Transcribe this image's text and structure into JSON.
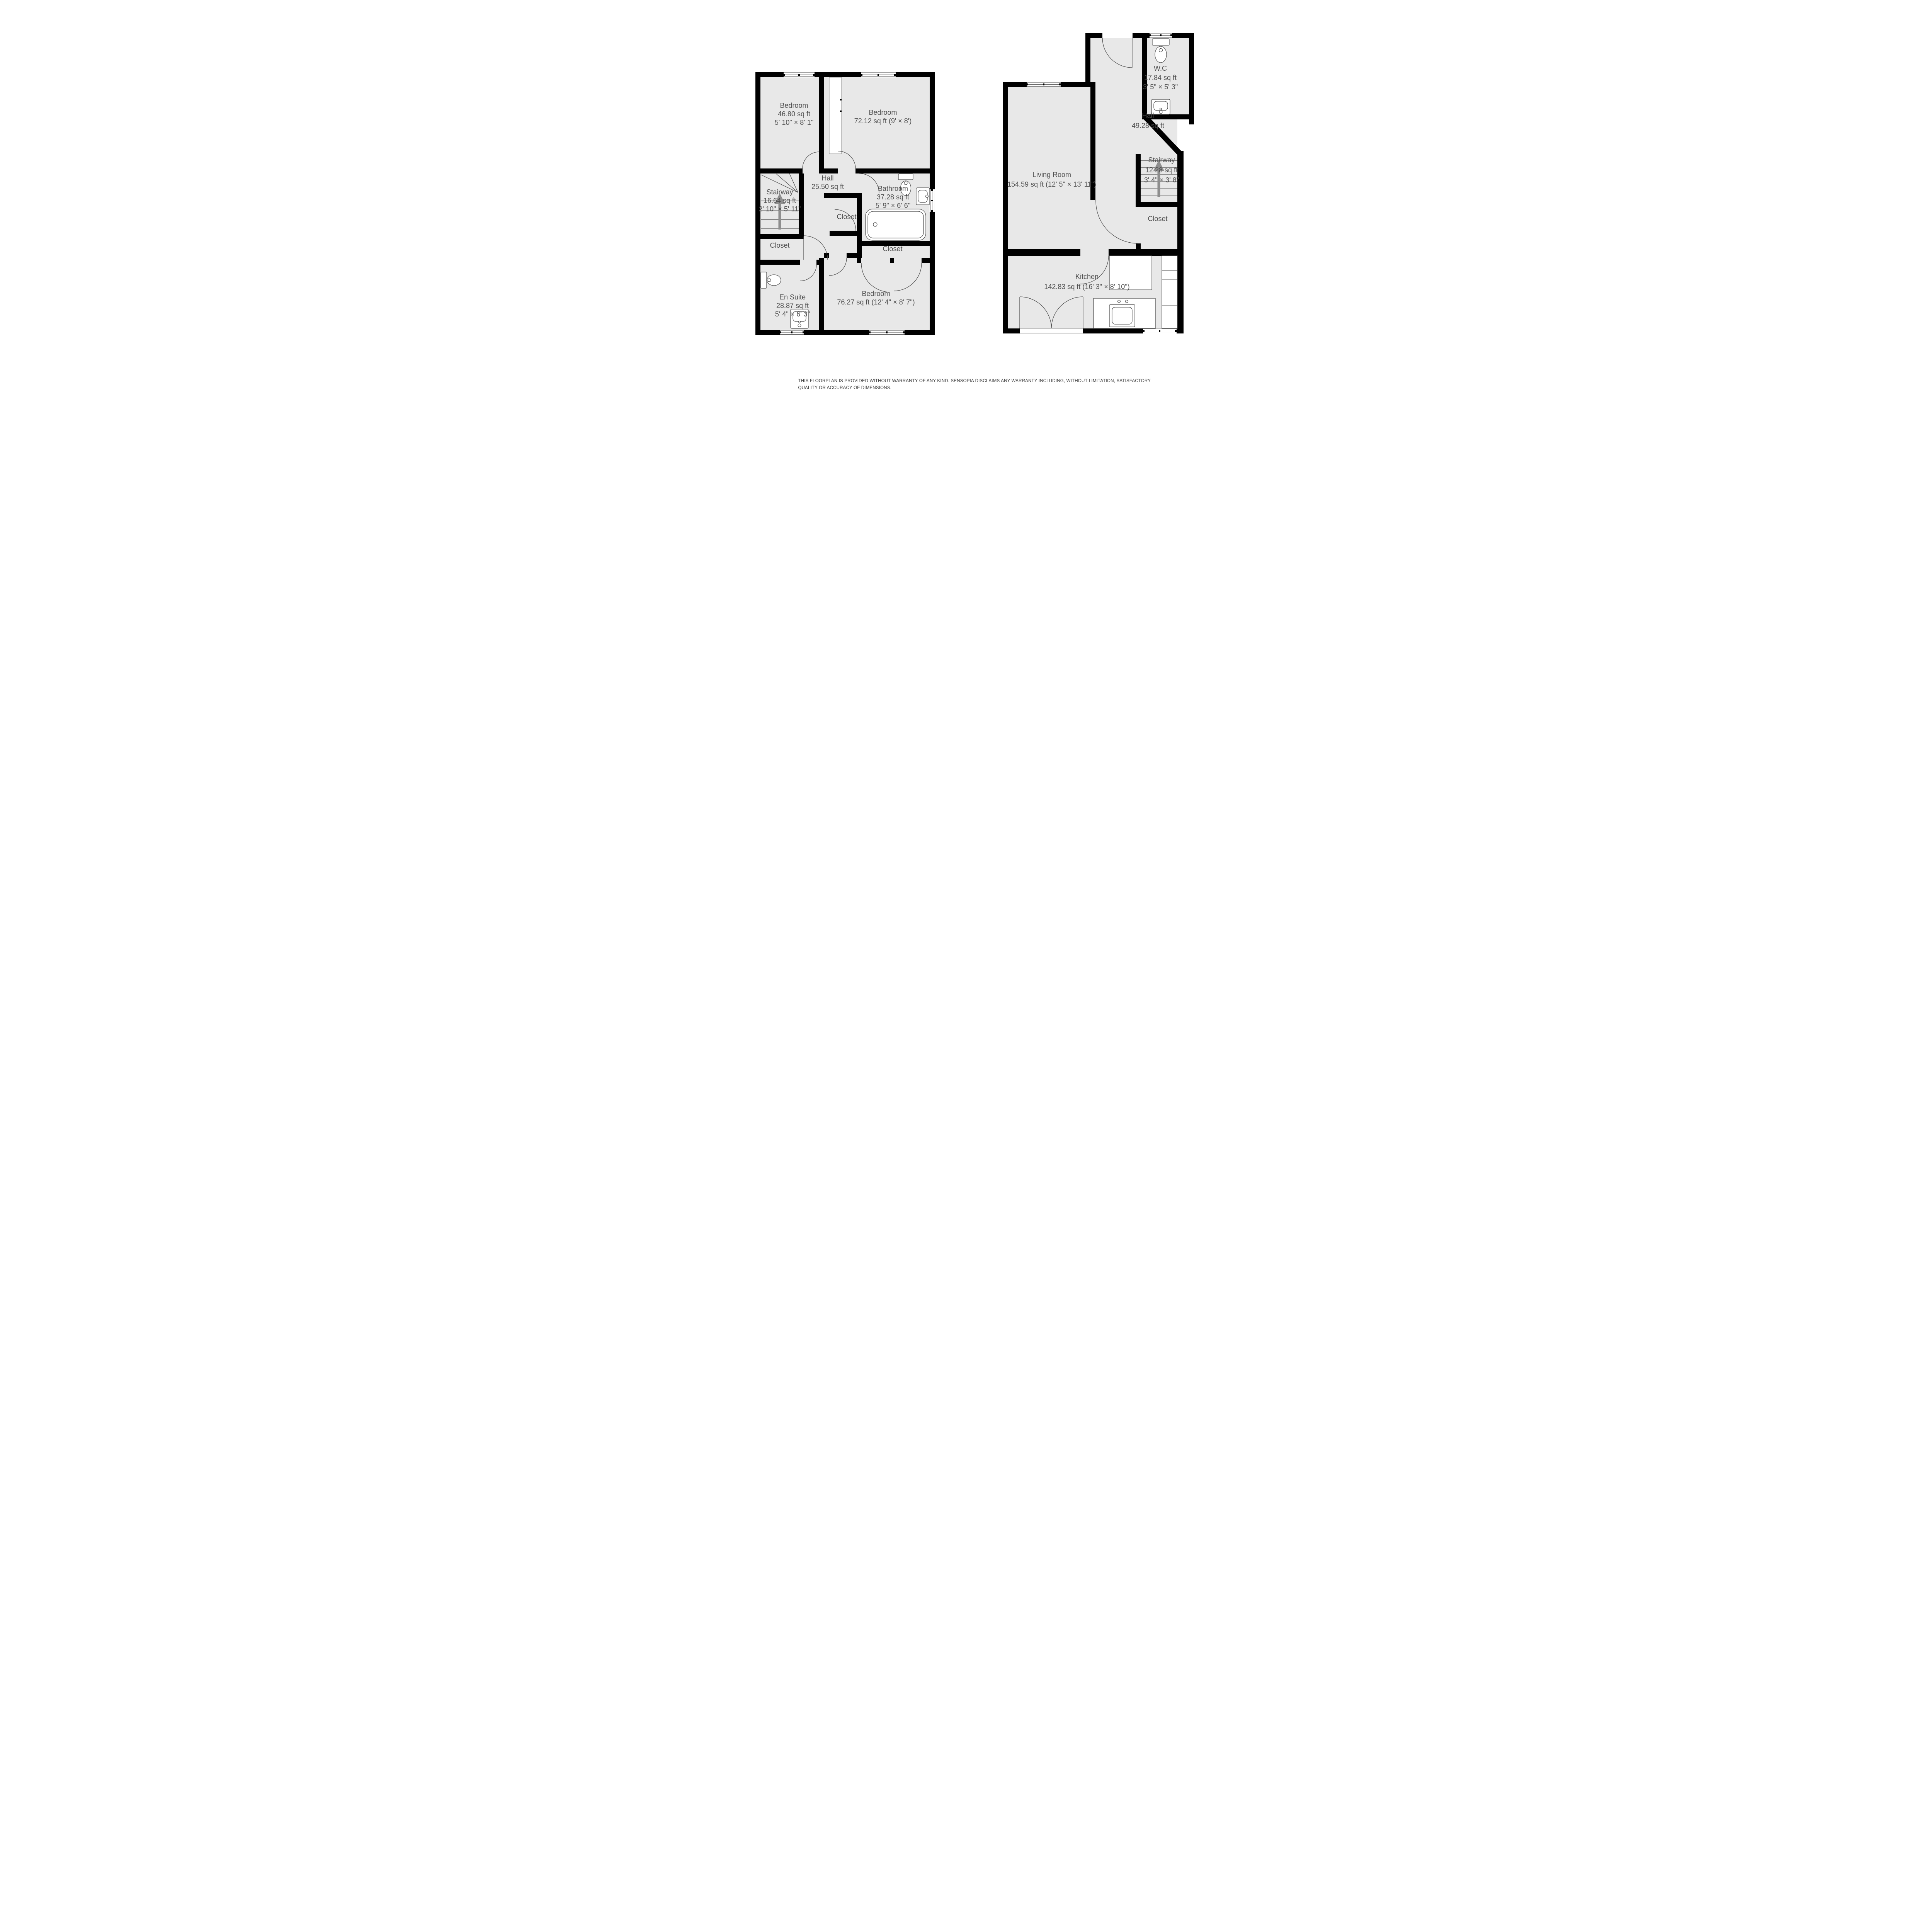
{
  "disclaimer": "THIS FLOORPLAN IS PROVIDED WITHOUT WARRANTY OF ANY KIND. SENSOPIA DISCLAIMS ANY WARRANTY INCLUDING, WITHOUT LIMITATION, SATISFACTORY QUALITY OR ACCURACY OF DIMENSIONS.",
  "colors": {
    "wall": "#000000",
    "floor_fill": "#e8e8e8",
    "background": "#ffffff",
    "fixture_line": "#4a4a4a",
    "label_text": "#4f4f4f",
    "stair_arrow": "#8e8e8e"
  },
  "floors": [
    {
      "id": "upper-floor",
      "rooms": [
        {
          "name": "Bedroom",
          "area": "46.80 sq ft",
          "dims": "5' 10\" × 8' 1\""
        },
        {
          "name": "Bedroom",
          "area": "72.12 sq ft (9' × 8')",
          "dims": ""
        },
        {
          "name": "Hall",
          "area": "25.50 sq ft",
          "dims": ""
        },
        {
          "name": "Stairway",
          "area": "16.64 sq ft",
          "dims": "2' 10\" × 5' 11\""
        },
        {
          "name": "Bathroom",
          "area": "37.28 sq ft",
          "dims": "5' 9\" × 6' 6\""
        },
        {
          "name": "Closet",
          "area": "",
          "dims": ""
        },
        {
          "name": "Closet",
          "area": "",
          "dims": ""
        },
        {
          "name": "Closet",
          "area": "",
          "dims": ""
        },
        {
          "name": "En Suite",
          "area": "28.87 sq ft",
          "dims": "5' 4\" × 6' 3\""
        },
        {
          "name": "Bedroom",
          "area": "76.27 sq ft (12' 4\" × 8' 7\")",
          "dims": ""
        }
      ]
    },
    {
      "id": "ground-floor",
      "rooms": [
        {
          "name": "W.C",
          "area": "17.84 sq ft",
          "dims": "3' 5\" × 5' 3\""
        },
        {
          "name": "Hall",
          "area": "49.28 sq ft",
          "dims": ""
        },
        {
          "name": "Living Room",
          "area": "154.59 sq ft (12' 5\" × 13' 11\")",
          "dims": ""
        },
        {
          "name": "Stairway",
          "area": "12.28 sq ft",
          "dims": "3' 4\" × 3' 8\""
        },
        {
          "name": "Closet",
          "area": "",
          "dims": ""
        },
        {
          "name": "Kitchen",
          "area": "142.83 sq ft (16' 3\" × 8' 10\")",
          "dims": ""
        }
      ]
    }
  ]
}
